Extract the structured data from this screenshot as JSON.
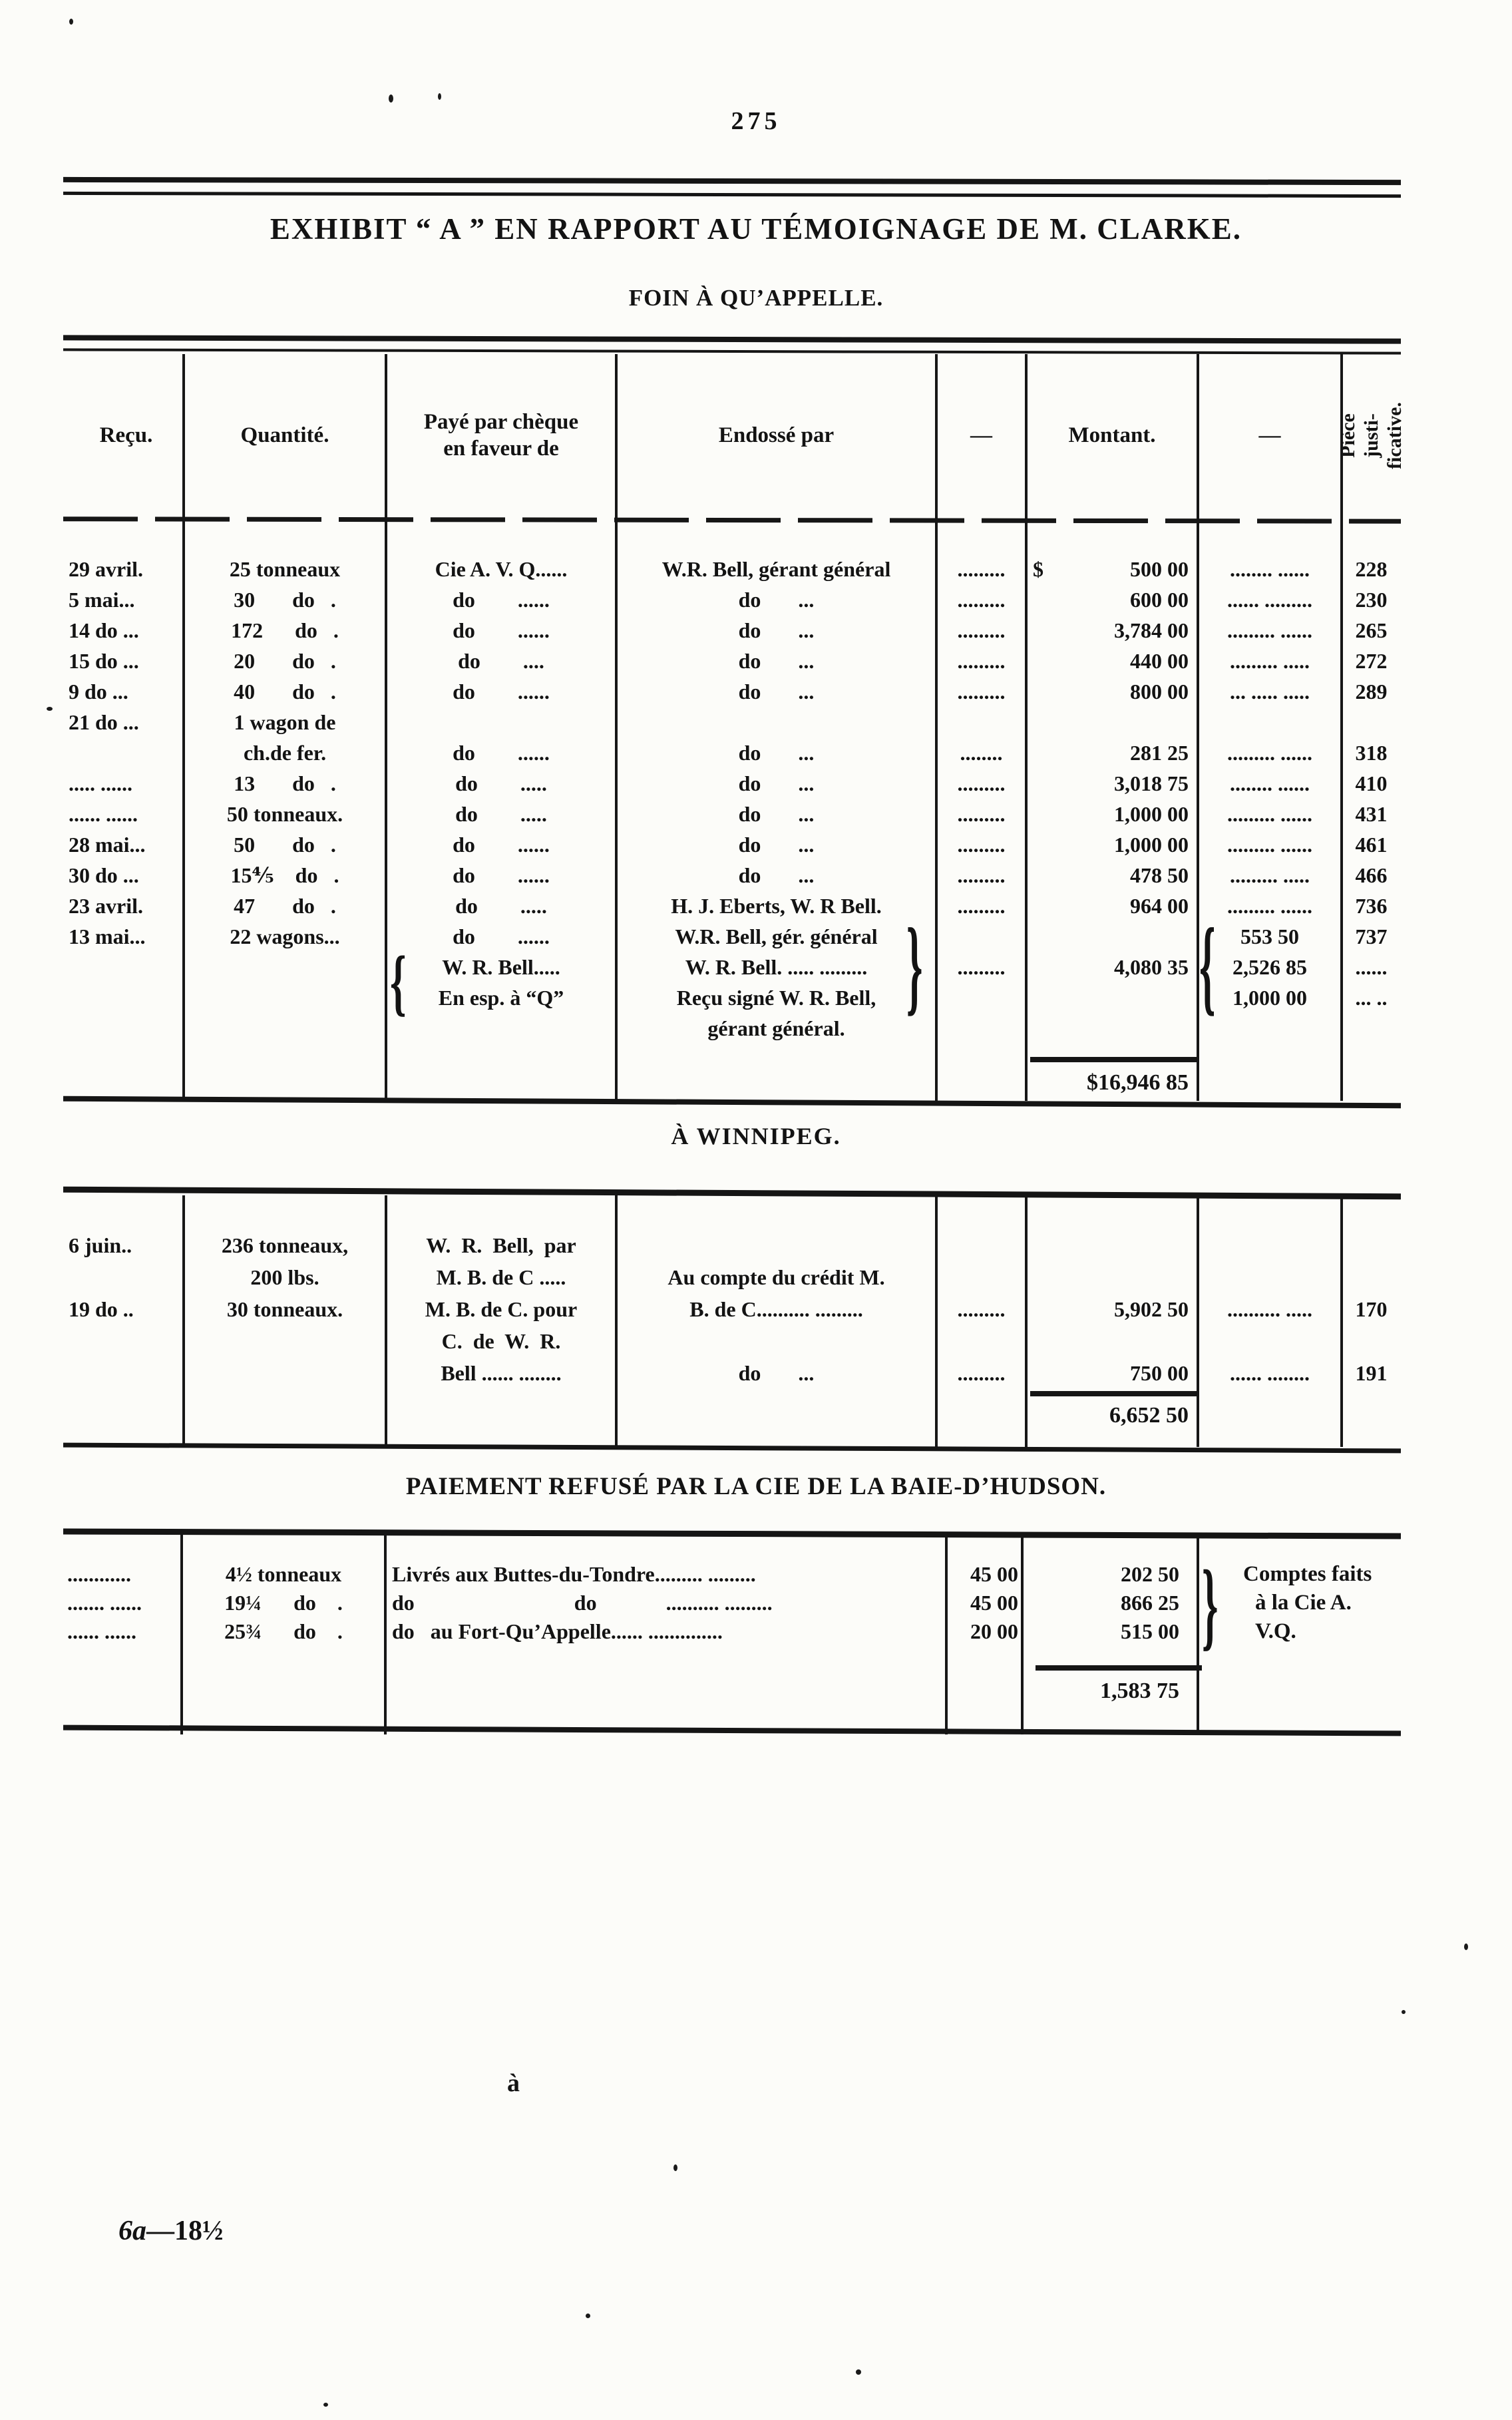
{
  "page": {
    "number": "275",
    "title": "EXHIBIT “ A ” EN RAPPORT AU TÉMOIGNAGE DE M. CLARKE.",
    "subtitle": "FOIN À QU’APPELLE.",
    "footer_italic": "6a",
    "footer_rest": "—18½",
    "stray_mark": "à"
  },
  "table1": {
    "headers": {
      "recu": "Reçu.",
      "quantite": "Quantité.",
      "paye": "Payé par chèque\nen faveur de",
      "endosse": "Endossé par",
      "dash1": "—",
      "montant": "Montant.",
      "dash2": "—",
      "piece": "Pièce justi-\nficative."
    },
    "currency": "$",
    "braces": {
      "payee": "{",
      "endorse": "}",
      "amounts": "{"
    },
    "rows": [
      [
        "29 avril.",
        "25 tonneaux",
        "Cie A. V. Q......",
        "W.R. Bell, gérant général",
        ".........",
        "500 00",
        "........ ......",
        "228"
      ],
      [
        "5 mai...",
        "30       do   .",
        "do        ......",
        "do       ...",
        ".........",
        "600 00",
        "...... .........",
        "230"
      ],
      [
        "14 do ...",
        "172      do   .",
        "do        ......",
        "do       ...",
        ".........",
        "3,784 00",
        "......... ......",
        "265"
      ],
      [
        "15 do ...",
        "20       do   .",
        "do        ....",
        "do       ...",
        ".........",
        "440 00",
        "......... .....",
        "272"
      ],
      [
        "9 do ...",
        "40       do   .",
        "do        ......",
        "do       ...",
        ".........",
        "800 00",
        "... ..... .....",
        "289"
      ],
      [
        "21 do ...",
        "1 wagon de",
        "",
        "",
        "",
        "",
        "",
        ""
      ],
      [
        "",
        "ch.de fer.",
        "do        ......",
        "do       ...",
        "........",
        "281 25",
        "......... ......",
        "318"
      ],
      [
        "..... ......",
        "13       do   .",
        "do        .....",
        "do       ...",
        ".........",
        "3,018 75",
        "........ ......",
        "410"
      ],
      [
        "...... ......",
        "50 tonneaux.",
        "do        .....",
        "do       ...",
        ".........",
        "1,000 00",
        "......... ......",
        "431"
      ],
      [
        "28 mai...",
        "50       do   .",
        "do        ......",
        "do       ...",
        ".........",
        "1,000 00",
        "......... ......",
        "461"
      ],
      [
        "30 do ...",
        "15⅘    do   .",
        "do        ......",
        "do       ...",
        ".........",
        "478 50",
        "......... .....",
        "466"
      ],
      [
        "23 avril.",
        "47       do   .",
        "do        .....",
        "H. J. Eberts, W. R Bell.",
        ".........",
        "964 00",
        "......... ......",
        "736"
      ],
      [
        "13 mai...",
        "22 wagons...",
        "do        ......",
        "W.R. Bell, gér. général",
        "",
        "",
        "553 50",
        "737"
      ],
      [
        "",
        "",
        "W. R. Bell.....",
        "W. R. Bell. ..... .........",
        ".........",
        "4,080 35",
        "2,526 85",
        "......"
      ],
      [
        "",
        "",
        "En esp. à “Q”",
        "Reçu signé W. R. Bell,",
        "",
        "",
        "1,000 00",
        "... .."
      ],
      [
        "",
        "",
        "",
        "gérant général.",
        "",
        "",
        "",
        ""
      ]
    ],
    "total": "$16,946 85"
  },
  "winnipeg": {
    "heading": "À WINNIPEG.",
    "rows": [
      [
        "6 juin..",
        "236 tonneaux,",
        "W.  R.  Bell,  par",
        "",
        "",
        "",
        "",
        ""
      ],
      [
        "",
        "200 lbs.",
        "M. B. de C .....",
        "Au compte du crédit M.",
        "",
        "",
        "",
        ""
      ],
      [
        "19 do ..",
        "30 tonneaux.",
        "M. B. de C. pour",
        "B. de C.......... .........",
        ".........",
        "5,902 50",
        ".......... .....",
        "170"
      ],
      [
        "",
        "",
        "C.  de  W.  R.",
        "",
        "",
        "",
        "",
        ""
      ],
      [
        "",
        "",
        "Bell ...... ........",
        "do       ...",
        ".........",
        "750 00",
        "...... ........",
        "191"
      ]
    ],
    "total": "6,652 50"
  },
  "hudson": {
    "heading": "PAIEMENT REFUSÉ PAR LA CIE DE LA BAIE-D’HUDSON.",
    "brace": "}",
    "note": [
      "Comptes faits",
      "à la Cie A.",
      "V.Q."
    ],
    "rows": [
      [
        "............",
        "4½ tonneaux",
        "Livrés aux Buttes-du-Tondre......... .........",
        "45 00",
        "202 50"
      ],
      [
        "....... ......",
        "19¼      do    .",
        "do                              do             .......... .........",
        "45 00",
        "866 25"
      ],
      [
        "...... ......",
        "25¾      do    .",
        "do   au Fort-Qu’Appelle...... ..............",
        "20 00",
        "515 00"
      ]
    ],
    "total": "1,583 75"
  }
}
